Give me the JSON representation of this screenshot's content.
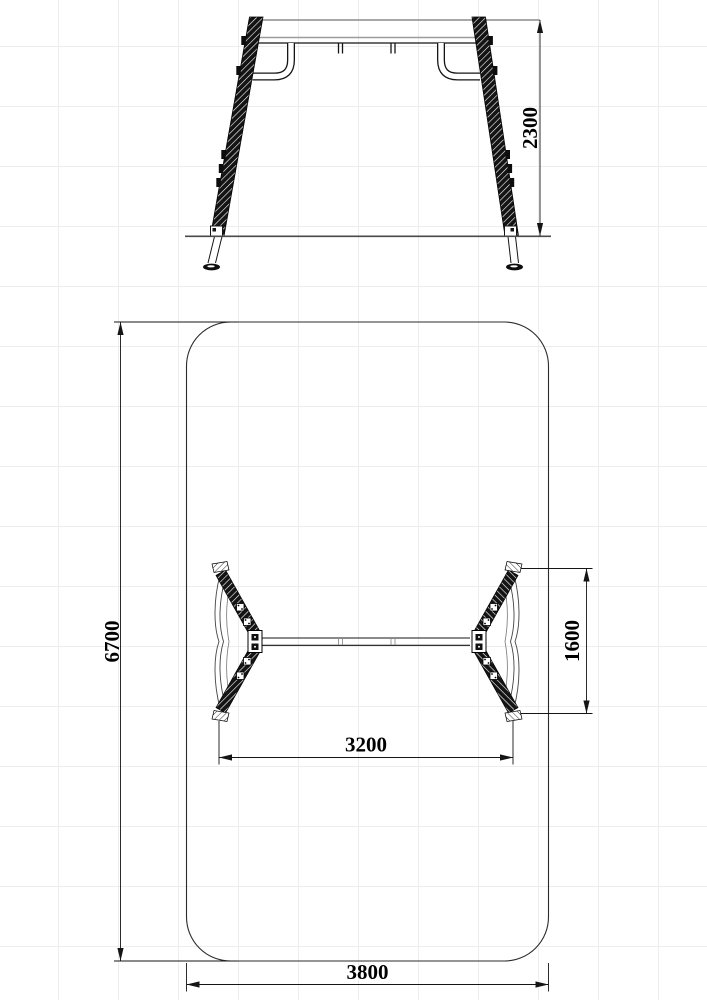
{
  "drawing_type": "swing-frame-technical-drawing",
  "dimensions": {
    "frame_height": "2300",
    "safety_zone_length": "6700",
    "frame_depth": "1600",
    "frame_span": "3200",
    "safety_zone_width": "3800"
  },
  "colors": {
    "outline": "#151515",
    "beam_highlight": "#9c9c9c",
    "ground_line": "#4a4a4a",
    "grid": "#ededed",
    "background": "#ffffff"
  }
}
